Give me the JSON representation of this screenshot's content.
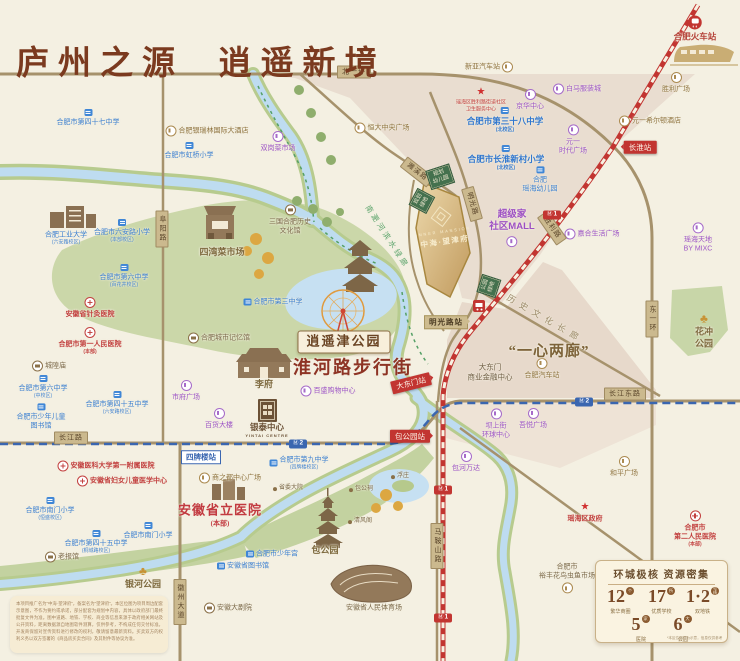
{
  "title": "庐州之源  逍遥新境",
  "colors": {
    "bg": "#f4f0e2",
    "title": "#7b3a1f",
    "road": "#a6926c",
    "railway_line1": "#c23531",
    "metro_line2": "#3a66b0",
    "river": "#bedcf0",
    "park": "#cbd7a9",
    "parcel_gold": "#d4b278",
    "green_box": "#44714e",
    "purple_poi": "#9d55c6",
    "blue_poi": "#3b7fd0",
    "red_poi": "#c2403f",
    "gold_poi": "#8f7440"
  },
  "project": {
    "en": "INNER MANSION",
    "cn": "中海·望津府"
  },
  "map": {
    "pois": [
      {
        "n": "school-47-middle",
        "t": "blue",
        "i": "school",
        "p": "top",
        "l": [
          "合肥市第四十七中学"
        ],
        "x": 88,
        "y": 118
      },
      {
        "n": "hotel-yinruilin",
        "t": "gold",
        "i": "goldc",
        "p": "left",
        "l": [
          "合肥银瑞林国际大酒店"
        ],
        "x": 207,
        "y": 131
      },
      {
        "n": "school-hongqiao",
        "t": "blue",
        "i": "school",
        "p": "top",
        "l": [
          "合肥市虹桥小学"
        ],
        "x": 189,
        "y": 151
      },
      {
        "n": "hfut-university",
        "t": "blue",
        "l": [
          "合肥工业大学"
        ],
        "s": "(六安路校区)",
        "x": 66,
        "y": 238
      },
      {
        "n": "school-luanlu-primary",
        "t": "blue",
        "i": "school",
        "p": "top",
        "l": [
          "合肥市六安路小学"
        ],
        "s": "(本部校区)",
        "x": 122,
        "y": 231
      },
      {
        "n": "school-no6-baihuajing",
        "t": "blue",
        "i": "school",
        "p": "top",
        "l": [
          "合肥市第六中学"
        ],
        "s": "(百花井校区)",
        "x": 124,
        "y": 276
      },
      {
        "n": "hospital-acupuncture",
        "t": "red",
        "i": "cross",
        "p": "top",
        "l": [
          "安徽省针灸医院"
        ],
        "x": 90,
        "y": 308
      },
      {
        "n": "hospital-first-people",
        "t": "red",
        "i": "cross",
        "p": "top",
        "l": [
          "合肥市第一人民医院"
        ],
        "s": "(本部)",
        "x": 90,
        "y": 341
      },
      {
        "n": "chenghuang-temple",
        "t": "brown",
        "i": "brownc",
        "p": "left",
        "l": [
          "城隍庙"
        ],
        "x": 49,
        "y": 366
      },
      {
        "n": "school-no6-mid",
        "t": "blue",
        "i": "school",
        "p": "top",
        "l": [
          "合肥市第六中学"
        ],
        "s": "(中校区)",
        "x": 43,
        "y": 387
      },
      {
        "n": "children-library",
        "t": "blue",
        "i": "school",
        "p": "top",
        "l": [
          "合肥市少年儿童",
          "图书馆"
        ],
        "x": 41,
        "y": 417
      },
      {
        "n": "school-45-luanlu",
        "t": "blue",
        "i": "school",
        "p": "top",
        "l": [
          "合肥市第四十五中学"
        ],
        "s": "(六安路校区)",
        "x": 117,
        "y": 403
      },
      {
        "n": "city-memory-hall",
        "t": "brown",
        "i": "brownc",
        "p": "left",
        "l": [
          "合肥城市记忆馆"
        ],
        "x": 219,
        "y": 338
      },
      {
        "n": "shifu-square",
        "t": "purple",
        "i": "purplec",
        "p": "top",
        "l": [
          "市府广场"
        ],
        "x": 186,
        "y": 391
      },
      {
        "n": "baihuo-building",
        "t": "purple",
        "i": "purplec",
        "p": "top",
        "l": [
          "百货大楼"
        ],
        "x": 219,
        "y": 419
      },
      {
        "n": "hospital-anyi-first",
        "t": "red",
        "i": "cross",
        "p": "left",
        "l": [
          "安徽医科大学第一附属医院"
        ],
        "x": 106,
        "y": 466
      },
      {
        "n": "hospital-women-children",
        "t": "red",
        "i": "cross",
        "p": "left",
        "l": [
          "安徽省妇女儿童医学中心"
        ],
        "x": 122,
        "y": 481
      },
      {
        "n": "school-nanmen-1",
        "t": "blue",
        "i": "school",
        "p": "top",
        "l": [
          "合肥市南门小学"
        ],
        "s": "(恒盛校区)",
        "x": 50,
        "y": 509
      },
      {
        "n": "school-45-tongcheng",
        "t": "blue",
        "i": "school",
        "p": "top",
        "l": [
          "合肥市第四十五中学"
        ],
        "s": "(桐城路校区)",
        "x": 96,
        "y": 542
      },
      {
        "n": "school-nanmen-2",
        "t": "blue",
        "i": "school",
        "p": "top",
        "l": [
          "合肥市南门小学"
        ],
        "x": 148,
        "y": 531
      },
      {
        "n": "laobaoguan",
        "t": "brown",
        "i": "brownc",
        "p": "left",
        "l": [
          "老报馆"
        ],
        "x": 62,
        "y": 557
      },
      {
        "n": "yinhe-park",
        "t": "parkname",
        "i": "treeg",
        "p": "top",
        "l": [
          "银河公园"
        ],
        "x": 143,
        "y": 578
      },
      {
        "n": "shangzhidu-center",
        "t": "gold",
        "i": "goldc",
        "p": "left",
        "l": [
          "商之都中心广场"
        ],
        "x": 230,
        "y": 478
      },
      {
        "n": "hospital-provincial",
        "t": "hospbig",
        "l": [
          "安徽省立医院"
        ],
        "s": "(本部)",
        "x": 220,
        "y": 515
      },
      {
        "n": "anhui-library",
        "t": "blue",
        "i": "school",
        "p": "left",
        "l": [
          "安徽省图书馆"
        ],
        "x": 243,
        "y": 566
      },
      {
        "n": "anhui-grand-theatre",
        "t": "brown",
        "i": "brownc",
        "p": "left",
        "l": [
          "安徽大剧院"
        ],
        "x": 228,
        "y": 608
      },
      {
        "n": "school-no9",
        "t": "blue",
        "i": "school",
        "p": "left",
        "l": [
          "合肥市第九中学"
        ],
        "s": "(四牌楼校区)",
        "x": 299,
        "y": 463
      },
      {
        "n": "shengwei-dayuan",
        "t": "tinybrown",
        "i": "dot",
        "p": "left",
        "l": [
          "省委大院"
        ],
        "x": 288,
        "y": 489
      },
      {
        "n": "baogong-shrine",
        "t": "tinybrown",
        "i": "dot",
        "p": "left",
        "l": [
          "包公祠"
        ],
        "x": 361,
        "y": 490
      },
      {
        "n": "fuzhuang",
        "t": "tinybrown",
        "i": "dot",
        "p": "left",
        "l": [
          "浮庄"
        ],
        "x": 400,
        "y": 477
      },
      {
        "n": "qingfeng-pavilion",
        "t": "tinybrown",
        "i": "dot",
        "p": "left",
        "l": [
          "清风阁"
        ],
        "x": 360,
        "y": 522
      },
      {
        "n": "baogong-park",
        "t": "parkname",
        "l": [
          "包公园"
        ],
        "x": 325,
        "y": 551
      },
      {
        "n": "youth-palace",
        "t": "blue",
        "i": "school",
        "p": "left",
        "l": [
          "合肥市少年宫"
        ],
        "x": 272,
        "y": 554
      },
      {
        "n": "provincial-stadium",
        "t": "brown",
        "l": [
          "安徽省人民体育场"
        ],
        "x": 374,
        "y": 608
      },
      {
        "n": "baohe-wanda",
        "t": "purple",
        "i": "purplec",
        "p": "top",
        "l": [
          "包河万达"
        ],
        "x": 466,
        "y": 462
      },
      {
        "n": "heping-square",
        "t": "gold",
        "i": "goldc",
        "p": "top",
        "l": [
          "和平广场"
        ],
        "x": 624,
        "y": 467
      },
      {
        "n": "yaohai-gov",
        "t": "red",
        "i": "star",
        "p": "top",
        "l": [
          "瑶海区政府"
        ],
        "x": 585,
        "y": 513
      },
      {
        "n": "hospital-second-people",
        "t": "red",
        "i": "cross",
        "p": "top",
        "l": [
          "合肥市",
          "第二人民医院"
        ],
        "s": "(本部)",
        "x": 695,
        "y": 529
      },
      {
        "n": "yufeng-market",
        "t": "brown",
        "i": "goldc",
        "p": "bottom",
        "l": [
          "合肥市",
          "裕丰花鸟虫鱼市场"
        ],
        "x": 567,
        "y": 578
      },
      {
        "n": "huachong-park",
        "t": "parkname",
        "i": "treeg",
        "p": "top",
        "l": [
          "花冲",
          "公园"
        ],
        "x": 704,
        "y": 331
      },
      {
        "n": "yaohai-tiandi",
        "t": "purple",
        "i": "purplec",
        "p": "top",
        "l": [
          "瑶海天地",
          "BY MIXC"
        ],
        "x": 698,
        "y": 238
      },
      {
        "n": "jiahe-plaza",
        "t": "purple",
        "i": "purplec",
        "p": "left",
        "l": [
          "嘉合生活广场"
        ],
        "x": 592,
        "y": 234
      },
      {
        "n": "supermall",
        "t": "shopbig",
        "i": "purplec",
        "p": "bottom",
        "l": [
          "超级家",
          "社区MALL"
        ],
        "x": 512,
        "y": 228
      },
      {
        "n": "yuanyi-times",
        "t": "purple",
        "i": "purplec",
        "p": "top",
        "l": [
          "元一",
          "时代广场"
        ],
        "x": 573,
        "y": 140
      },
      {
        "n": "baima-clothing",
        "t": "purple",
        "i": "purplec",
        "p": "left",
        "l": [
          "白马服装城"
        ],
        "x": 577,
        "y": 89
      },
      {
        "n": "jinghua-center",
        "t": "purple",
        "i": "purplec",
        "p": "top",
        "l": [
          "京华中心"
        ],
        "x": 530,
        "y": 100
      },
      {
        "n": "school-38",
        "t": "schoolbig",
        "i": "school",
        "p": "top",
        "l": [
          "合肥市第三十八中学"
        ],
        "s": "(北校区)",
        "x": 505,
        "y": 120
      },
      {
        "n": "school-changhuai",
        "t": "schoolbig",
        "i": "school",
        "p": "top",
        "l": [
          "合肥市长淮新村小学"
        ],
        "s": "(北校区)",
        "x": 506,
        "y": 158
      },
      {
        "n": "yaohai-kindergarten",
        "t": "blue",
        "i": "school",
        "p": "top",
        "l": [
          "合肥",
          "瑶海幼儿园"
        ],
        "x": 540,
        "y": 180
      },
      {
        "n": "community-health",
        "t": "redtiny",
        "i": "star",
        "p": "top",
        "l": [
          "瑶海区胜利路街道社区",
          "卫生服务中心"
        ],
        "x": 481,
        "y": 100
      },
      {
        "n": "xinya-bus-station",
        "t": "gold",
        "i": "goldc",
        "p": "right",
        "l": [
          "新亚汽车站"
        ],
        "x": 489,
        "y": 67
      },
      {
        "n": "hefei-railway-station",
        "t": "redstation",
        "i": "train",
        "p": "top",
        "l": [
          "合肥火车站"
        ],
        "x": 695,
        "y": 29
      },
      {
        "n": "shengli-square",
        "t": "gold",
        "i": "goldc",
        "p": "top",
        "l": [
          "胜利广场"
        ],
        "x": 676,
        "y": 83
      },
      {
        "n": "hilton-hotel",
        "t": "gold",
        "i": "goldc",
        "p": "left",
        "l": [
          "元一希尔顿酒店"
        ],
        "x": 650,
        "y": 121
      },
      {
        "n": "school-no3",
        "t": "blue",
        "i": "school",
        "p": "left",
        "l": [
          "合肥市第三中学"
        ],
        "x": 273,
        "y": 302
      },
      {
        "n": "three-kingdoms-hall",
        "t": "brown",
        "i": "brownc",
        "p": "top",
        "l": [
          "三国合肥历史",
          "文化馆"
        ],
        "x": 290,
        "y": 220
      },
      {
        "n": "shuanggang-market",
        "t": "purple",
        "i": "purplec",
        "p": "top",
        "l": [
          "双岗菜市场"
        ],
        "x": 278,
        "y": 142
      },
      {
        "n": "hengda-plaza",
        "t": "gold",
        "i": "goldc",
        "p": "left",
        "l": [
          "恒大中央广场"
        ],
        "x": 382,
        "y": 128
      },
      {
        "n": "siwan-market",
        "t": "parkname",
        "l": [
          "四湾菜市场"
        ],
        "x": 222,
        "y": 253
      },
      {
        "n": "lifu",
        "t": "parkname",
        "l": [
          "李府"
        ],
        "x": 264,
        "y": 385
      },
      {
        "n": "baisheng-mall",
        "t": "purple",
        "i": "purplec",
        "p": "left",
        "l": [
          "百盛购物中心"
        ],
        "x": 328,
        "y": 391
      },
      {
        "n": "yintai-center",
        "t": "yintai",
        "l": [
          "银泰中心",
          "YINTAI CENTRE"
        ],
        "x": 267,
        "y": 430
      },
      {
        "n": "hefei-bus-station",
        "t": "gold",
        "i": "goldc",
        "p": "top",
        "l": [
          "合肥汽车站"
        ],
        "x": 542,
        "y": 369
      },
      {
        "n": "dadongmen-cbd",
        "t": "browncenter",
        "l": [
          "大东门",
          "商业金融中心"
        ],
        "x": 490,
        "y": 372
      },
      {
        "n": "bashangjie-center",
        "t": "purple",
        "i": "purplec",
        "p": "top",
        "l": [
          "坝上街",
          "环球中心"
        ],
        "x": 496,
        "y": 424
      },
      {
        "n": "wuyue-plaza",
        "t": "purple",
        "i": "purplec",
        "p": "top",
        "l": [
          "吾悦广场"
        ],
        "x": 533,
        "y": 419
      },
      {
        "n": "xiaoyaojin-park-label",
        "t": "parkbox",
        "l": [
          "逍遥津公园"
        ],
        "x": 344,
        "y": 342
      },
      {
        "n": "huaihe-road-street",
        "t": "streetred",
        "l": [
          "淮河路步行街"
        ],
        "x": 353,
        "y": 368
      },
      {
        "n": "one-heart-two-corridors",
        "t": "quote",
        "l": [
          "“一心两廊”"
        ],
        "x": 549,
        "y": 352
      },
      {
        "n": "history-culture-corridor",
        "t": "corridor",
        "l": [
          "历史文化长廊"
        ],
        "x": 545,
        "y": 319,
        "r": 30
      },
      {
        "n": "riverside-greenway",
        "t": "greenway",
        "l": [
          "南淝河滨水绿廊"
        ],
        "x": 387,
        "y": 237,
        "r": 57
      }
    ],
    "stations": [
      {
        "n": "station-changhuai",
        "text": "长淮站",
        "x": 640,
        "y": 147,
        "line": "1",
        "pt": "l"
      },
      {
        "n": "station-mingguanglu",
        "text": "明光路站",
        "x": 446,
        "y": 322,
        "line": "tan",
        "pt": "r"
      },
      {
        "n": "station-dadongmen",
        "text": "大东门站",
        "x": 411,
        "y": 383,
        "line": "1",
        "rot": -14,
        "pt": "r"
      },
      {
        "n": "station-baogongyuan",
        "text": "包公园站",
        "x": 410,
        "y": 436,
        "line": "1",
        "pt": "r"
      },
      {
        "n": "station-sipailou",
        "text": "四牌楼站",
        "x": 201,
        "y": 457,
        "line": "2"
      }
    ],
    "road_labels": [
      {
        "text": "北一环",
        "x": 354,
        "y": 72
      },
      {
        "text": "长江路",
        "x": 71,
        "y": 438
      },
      {
        "text": "长江东路",
        "x": 625,
        "y": 394
      },
      {
        "text": "阜阳路",
        "x": 162,
        "y": 229,
        "v": true
      },
      {
        "text": "马鞍山路",
        "x": 437,
        "y": 546,
        "v": true
      },
      {
        "text": "徽州大道",
        "x": 180,
        "y": 602,
        "v": true
      },
      {
        "text": "东一环",
        "x": 652,
        "y": 319,
        "v": true
      },
      {
        "text": "濉溪路",
        "x": 417,
        "y": 172,
        "r": 38
      },
      {
        "text": "明光路",
        "x": 472,
        "y": 204,
        "r": 74
      },
      {
        "text": "胜利路",
        "x": 552,
        "y": 228,
        "r": 55
      }
    ],
    "metro_badges": [
      {
        "x": 298,
        "y": 444,
        "line": "2"
      },
      {
        "x": 584,
        "y": 402,
        "line": "2"
      },
      {
        "x": 552,
        "y": 215,
        "line": "1"
      },
      {
        "x": 443,
        "y": 490,
        "line": "1"
      },
      {
        "x": 443,
        "y": 618,
        "line": "1"
      }
    ],
    "green_boxes": [
      {
        "lines": [
          "规划",
          "幼儿园"
        ],
        "x": 440,
        "y": 177,
        "r": -18
      },
      {
        "lines": [
          "规划",
          "绿地"
        ],
        "x": 422,
        "y": 201,
        "r": -62
      },
      {
        "lines": [
          "公园",
          "绿地"
        ],
        "x": 489,
        "y": 286,
        "r": -72
      }
    ]
  },
  "stats": {
    "title": "环城极核  资源密集",
    "items": [
      {
        "num": "12",
        "unit": "个",
        "label": "繁华商圈"
      },
      {
        "num": "17",
        "unit": "所",
        "label": "优质学校"
      },
      {
        "num": "1·2",
        "unit": "号线",
        "label": "双地铁"
      },
      {
        "num": "5",
        "unit": "家",
        "label": "医院"
      },
      {
        "num": "6",
        "unit": "大",
        "label": "公园"
      }
    ],
    "note": "*本区位图仅为示意，信息仅供参考"
  },
  "disclaimer": "本项目推广名为“中海·望津府”，备案名为“望津府”。本区位图为项目周边配套示意图，不作为要约或承诺，部分配套为规划中内容，具体以政府部门最终批复文件为准。图中道路、地铁、学校、商业等信息来源于政府相关网站及公开资料，距离数据源自地图软件测算，仅供参考，不构成任何交付标准。开发商保留对宣传资料进行修改的权利，敬请留意最新资料。买卖双方的权利义务以双方签署的《商品房买卖合同》及其附件等协议为准。"
}
